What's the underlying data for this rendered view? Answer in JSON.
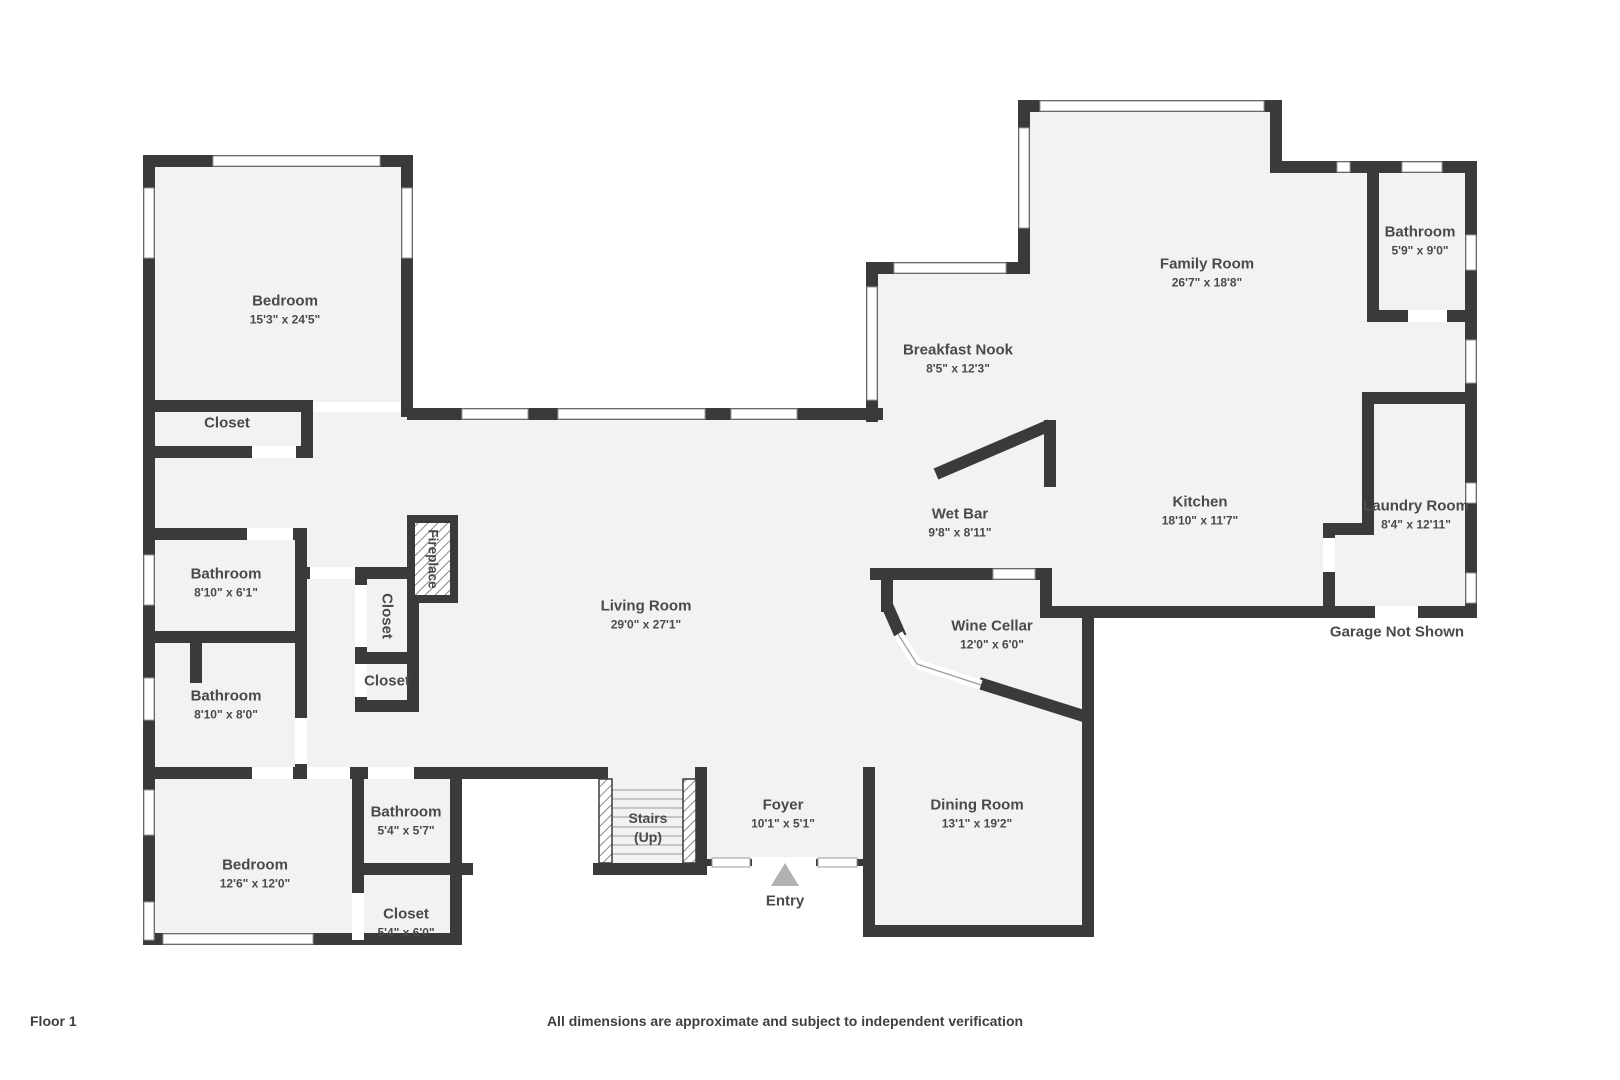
{
  "colors": {
    "wall": "#3a3a3c",
    "floor": "#f2f2f2",
    "background": "#ffffff",
    "label_text": "#4a4a4c",
    "entry_arrow": "#b1b1b3"
  },
  "rooms": [
    {
      "id": "bedroom-upper",
      "name": "Bedroom",
      "dims": "15'3\" x 24'5\""
    },
    {
      "id": "closet-upper",
      "name": "Closet",
      "dims": ""
    },
    {
      "id": "bathroom-1",
      "name": "Bathroom",
      "dims": "8'10\" x 6'1\""
    },
    {
      "id": "bathroom-2",
      "name": "Bathroom",
      "dims": "8'10\" x 8'0\""
    },
    {
      "id": "bedroom-lower",
      "name": "Bedroom",
      "dims": "12'6\" x 12'0\""
    },
    {
      "id": "bathroom-lower",
      "name": "Bathroom",
      "dims": "5'4\" x 5'7\""
    },
    {
      "id": "closet-lower",
      "name": "Closet",
      "dims": "5'4\" x 6'0\""
    },
    {
      "id": "living-room",
      "name": "Living Room",
      "dims": "29'0\" x 27'1\""
    },
    {
      "id": "closet-hall-vertical",
      "name": "Closet",
      "dims": ""
    },
    {
      "id": "closet-hall-small",
      "name": "Closet",
      "dims": ""
    },
    {
      "id": "fireplace",
      "name": "Fireplace",
      "dims": ""
    },
    {
      "id": "stairs",
      "name": "Stairs",
      "dims": "(Up)"
    },
    {
      "id": "foyer",
      "name": "Foyer",
      "dims": "10'1\" x 5'1\""
    },
    {
      "id": "dining-room",
      "name": "Dining Room",
      "dims": "13'1\" x 19'2\""
    },
    {
      "id": "wine-cellar",
      "name": "Wine Cellar",
      "dims": "12'0\" x 6'0\""
    },
    {
      "id": "wet-bar",
      "name": "Wet Bar",
      "dims": "9'8\" x 8'11\""
    },
    {
      "id": "breakfast-nook",
      "name": "Breakfast Nook",
      "dims": "8'5\" x 12'3\""
    },
    {
      "id": "family-room",
      "name": "Family Room",
      "dims": "26'7\" x 18'8\""
    },
    {
      "id": "kitchen",
      "name": "Kitchen",
      "dims": "18'10\" x 11'7\""
    },
    {
      "id": "bathroom-upper-right",
      "name": "Bathroom",
      "dims": "5'9\" x 9'0\""
    },
    {
      "id": "laundry-room",
      "name": "Laundry Room",
      "dims": "8'4\" x 12'11\""
    }
  ],
  "annotations": {
    "entry": "Entry",
    "garage_note": "Garage Not Shown"
  },
  "footer": {
    "floor_label": "Floor 1",
    "disclaimer": "All dimensions are approximate and subject to independent verification"
  }
}
